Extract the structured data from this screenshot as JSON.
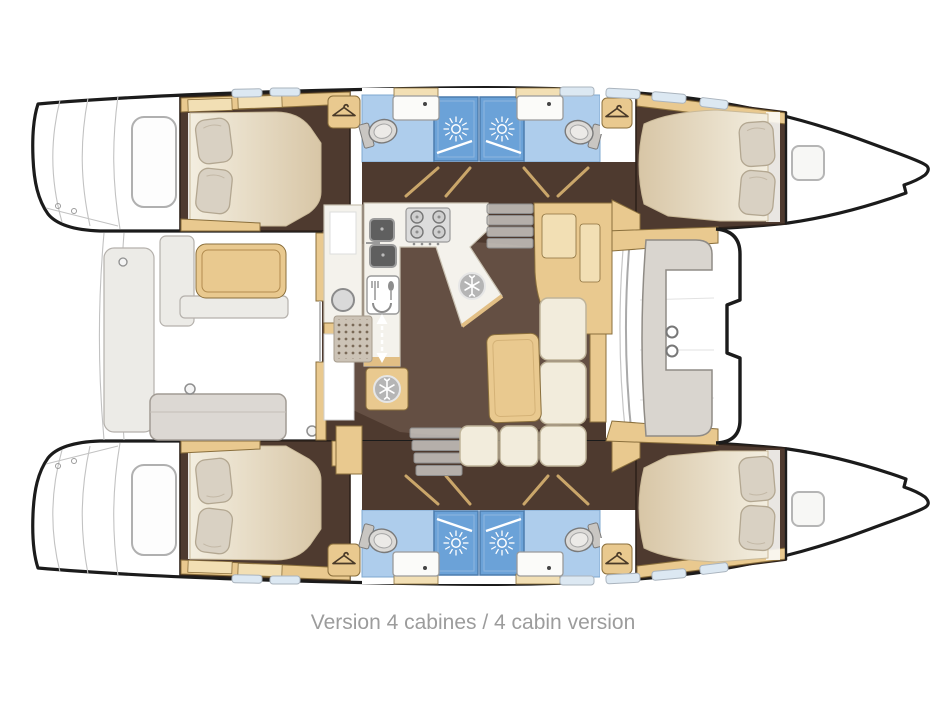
{
  "caption": {
    "text": "Version 4 cabines / 4 cabin version"
  },
  "palette": {
    "hull_outline": "#1b1b1b",
    "floor_dark": "#4e3a2f",
    "floor_shadow": "#8a7263",
    "wood": "#e9c98f",
    "wood_light": "#f2dfb4",
    "wood_edge": "#8a6f3c",
    "counter": "#f4f2ec",
    "bed_light": "#f1ebdc",
    "bed_dark": "#d8c6a6",
    "pillow": "#d9d1c3",
    "pillow_edge": "#b3a791",
    "bath_floor": "#aecdec",
    "shower_blue": "#6ba2d8",
    "cushion_cream": "#f2ecdc",
    "bench_grey": "#d9d5cf",
    "hatch_blue": "#dce8f2",
    "caption_grey": "#9c9c9c"
  },
  "plan": {
    "type": "catamaran-deck-plan",
    "cabin_count": 4,
    "bathroom_count": 4,
    "shower_count": 4,
    "toilet_count": 4,
    "bed_count": 4,
    "wardrobe_count": 4,
    "galley": {
      "stove_burners": 4,
      "sinks": 2,
      "fridges": 2
    },
    "icons": [
      "shower-sun-icon",
      "coat-hanger-icon",
      "snowflake-fridge-icon",
      "stove-burners-icon",
      "cutlery-icon",
      "companionway-arrow-icon"
    ]
  }
}
